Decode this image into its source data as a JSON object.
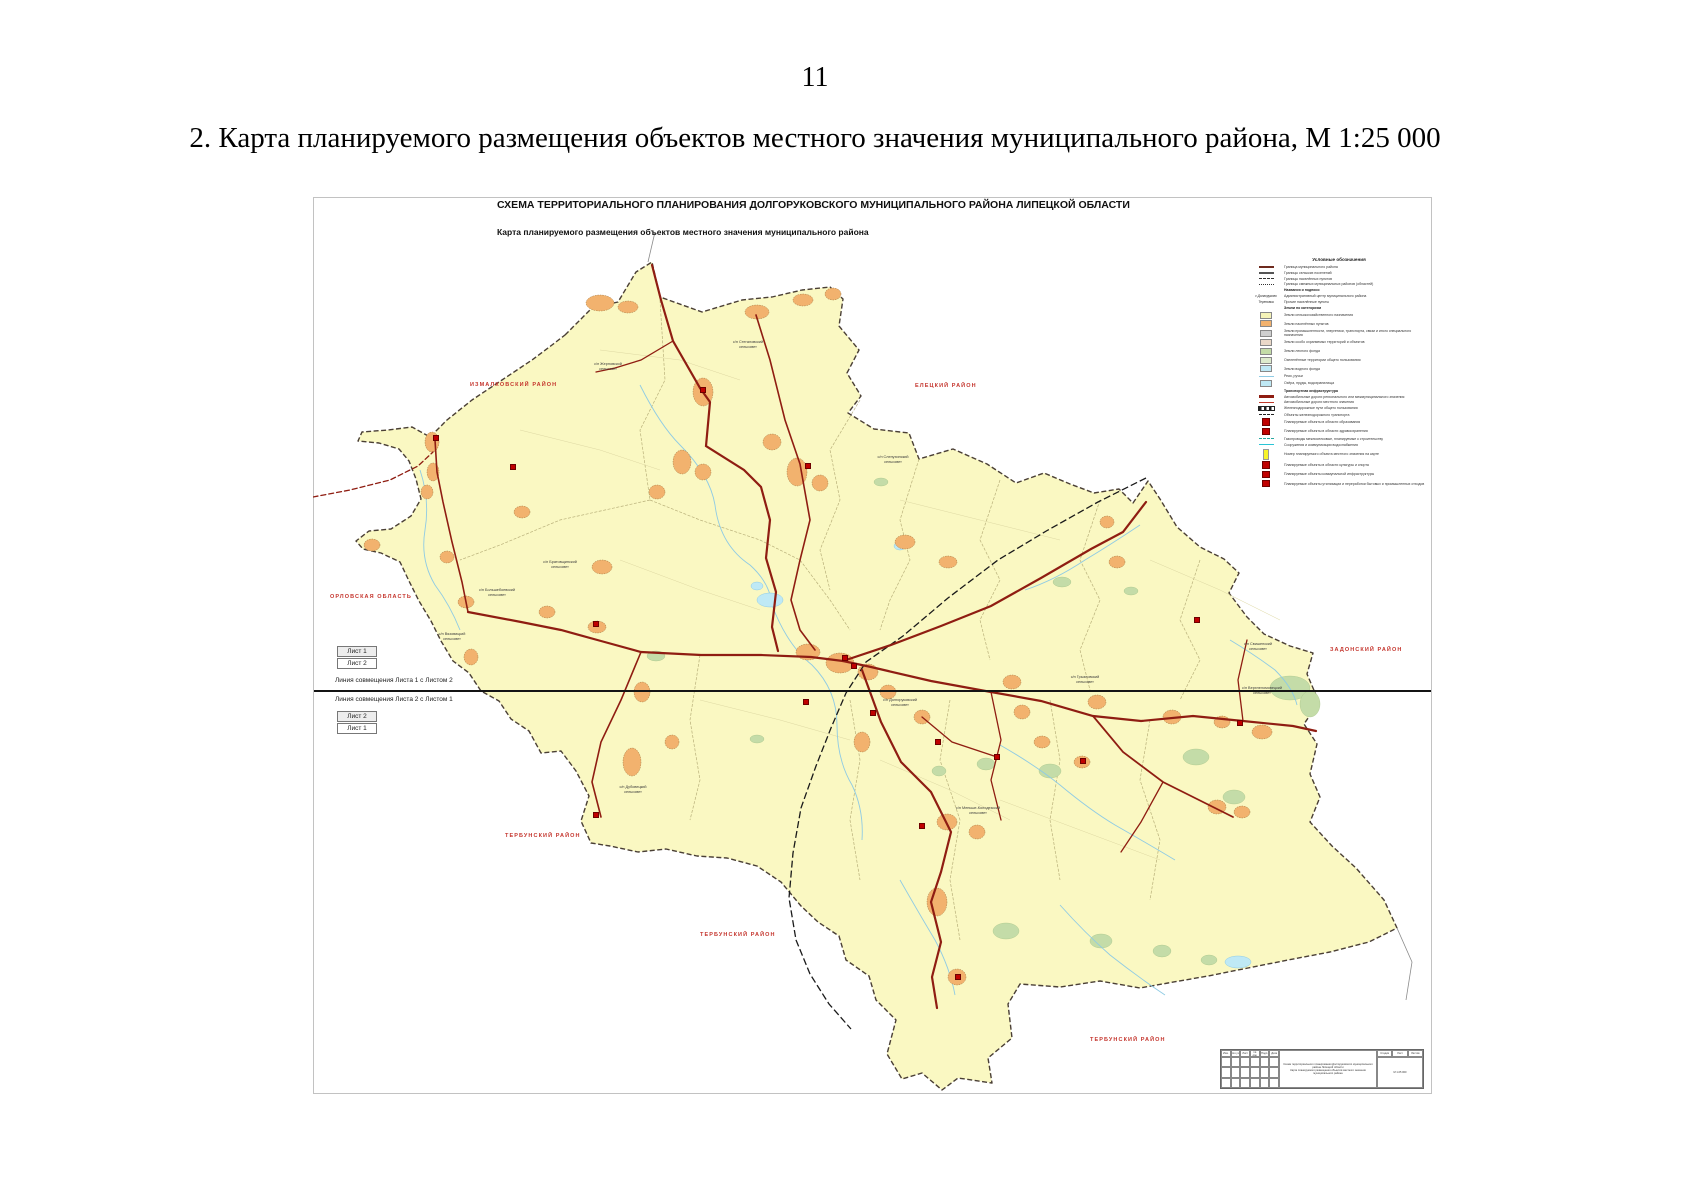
{
  "page": {
    "number": "11",
    "caption": "2. Карта планируемого размещения объектов местного значения муниципального района, М 1:25 000"
  },
  "sheet": {
    "title": "СХЕМА ТЕРРИТОРИАЛЬНОГО ПЛАНИРОВАНИЯ ДОЛГОРУКОВСКОГО МУНИЦИПАЛЬНОГО РАЙОНА ЛИПЕЦКОЙ ОБЛАСТИ",
    "subtitle": "Карта планируемого размещения объектов местного значения муниципального района"
  },
  "sheet_index": {
    "sheet1": "Лист 1",
    "sheet2": "Лист 2",
    "join1": "Линия совмещения Листа 1 с Листом 2",
    "join2": "Линия совмещения Листа 2 с Листом 1"
  },
  "legend": {
    "title": "Условные обозначения",
    "items": [
      {
        "sw": "band",
        "c": "#6e2a1e",
        "label": "Граница муниципального района"
      },
      {
        "sw": "band",
        "c": "#555555",
        "label": "Границы сельских поселений"
      },
      {
        "sw": "dash",
        "c": "#333333",
        "label": "Границы населённых пунктов"
      },
      {
        "sw": "dashdot",
        "c": "#333333",
        "label": "Границы смежных муниципальных районов (областей)"
      },
      {
        "sw": "none",
        "label": "Названия и подписи"
      },
      {
        "sw": "text",
        "st": "с.Долгоруково",
        "label": "Административный центр муниципального района"
      },
      {
        "sw": "text",
        "st": "Тереховка",
        "label": "Прочие населённые пункты"
      },
      {
        "sw": "none",
        "label": "Земли по категориям"
      },
      {
        "sw": "fill",
        "c": "#F5F3B8",
        "label": "Земли сельскохозяйственного назначения"
      },
      {
        "sw": "fill",
        "c": "#F2B26E",
        "label": "Земли населённых пунктов"
      },
      {
        "sw": "fill",
        "c": "#CFCFCF",
        "label": "Земли промышленности, энергетики, транспорта, связи и иного специального назначения"
      },
      {
        "sw": "fill",
        "c": "#EAD8C8",
        "label": "Земли особо охраняемых территорий и объектов"
      },
      {
        "sw": "fill",
        "c": "#C4DCA8",
        "label": "Земли лесного фонда"
      },
      {
        "sw": "fill",
        "c": "#DDEBCC",
        "label": "Озеленённые территории общего пользования"
      },
      {
        "sw": "bluefill",
        "c": "#BFE9F5",
        "label": "Земли водного фонда"
      },
      {
        "sw": "line",
        "c": "#8FCBE4",
        "label": "Реки, ручьи"
      },
      {
        "sw": "bluefill",
        "c": "#BFE9F5",
        "label": "Озёра, пруды, водохранилища"
      },
      {
        "sw": "none",
        "label": "Транспортная инфраструктура"
      },
      {
        "sw": "band",
        "c": "#8F1D12",
        "label": "Автомобильные дороги регионального или межмуниципального значения"
      },
      {
        "sw": "line",
        "c": "#C03A2B",
        "label": "Автомобильные дороги местного значения"
      },
      {
        "sw": "rail",
        "c": "#222222",
        "label": "Железнодорожные пути общего пользования"
      },
      {
        "sw": "dash",
        "c": "#222222",
        "label": "Объекты железнодорожного транспорта"
      },
      {
        "sw": "square",
        "c": "#C00000",
        "label": "Планируемые объекты в области образования"
      },
      {
        "sw": "square",
        "c": "#C00000",
        "label": "Планируемые объекты в области здравоохранения"
      },
      {
        "sw": "dash",
        "c": "#29A8A0",
        "label": "Газопроводы межпоселковые, планируемые к строительству"
      },
      {
        "sw": "line",
        "c": "#29C5D6",
        "label": "Сооружения и коммуникации водоснабжения"
      },
      {
        "sw": "tag",
        "c": "#F7F32A",
        "label": "Номер планируемого объекта местного значения на карте"
      },
      {
        "sw": "square",
        "c": "#C00000",
        "label": "Планируемые объекты в области культуры и спорта"
      },
      {
        "sw": "square",
        "c": "#C00000",
        "label": "Планируемые объекты коммунальной инфраструктуры"
      },
      {
        "sw": "square",
        "c": "#C00000",
        "label": "Планируемые объекты утилизации и переработки бытовых и промышленных отходов"
      }
    ]
  },
  "map": {
    "district_labels": [
      {
        "text": "ИЗМАЛКОВСКИЙ РАЙОН",
        "x": 470,
        "y": 382
      },
      {
        "text": "ЕЛЕЦКИЙ РАЙОН",
        "x": 915,
        "y": 383
      },
      {
        "text": "ОРЛОВСКАЯ ОБЛАСТЬ",
        "x": 330,
        "y": 594
      },
      {
        "text": "ЗАДОНСКИЙ РАЙОН",
        "x": 1330,
        "y": 647
      },
      {
        "text": "ТЕРБУНСКИЙ РАЙОН",
        "x": 505,
        "y": 833
      },
      {
        "text": "ТЕРБУНСКИЙ РАЙОН",
        "x": 700,
        "y": 932
      },
      {
        "text": "ТЕРБУНСКИЙ РАЙОН",
        "x": 1090,
        "y": 1037
      }
    ],
    "settlement_labels": [
      {
        "text": "с/п Жерновской\nсельсовет",
        "x": 608,
        "y": 362
      },
      {
        "text": "с/п Стегаловский\nсельсовет",
        "x": 748,
        "y": 340
      },
      {
        "text": "с/п Слепухинский\nсельсовет",
        "x": 893,
        "y": 455
      },
      {
        "text": "с/п Братовщинский\nсельсовет",
        "x": 560,
        "y": 560
      },
      {
        "text": "с/п Большебоевский\nсельсовет",
        "x": 497,
        "y": 588
      },
      {
        "text": "с/п Вязовицкий\nсельсовет",
        "x": 452,
        "y": 632
      },
      {
        "text": "с/п Дубовецкий\nсельсовет",
        "x": 633,
        "y": 785
      },
      {
        "text": "с/п Долгоруковский\nсельсовет",
        "x": 900,
        "y": 698
      },
      {
        "text": "с/п Грызловский\nсельсовет",
        "x": 1085,
        "y": 675
      },
      {
        "text": "с/п Меньше-Колодезский\nсельсовет",
        "x": 978,
        "y": 806
      },
      {
        "text": "с/п Свишенский\nсельсовет",
        "x": 1258,
        "y": 642
      },
      {
        "text": "с/п Верхнеломовецкий\nсельсовет",
        "x": 1262,
        "y": 686
      }
    ],
    "planned_object_markers": [
      [
        436,
        438
      ],
      [
        513,
        467
      ],
      [
        703,
        390
      ],
      [
        808,
        466
      ],
      [
        596,
        624
      ],
      [
        806,
        702
      ],
      [
        845,
        658
      ],
      [
        854,
        666
      ],
      [
        873,
        713
      ],
      [
        922,
        826
      ],
      [
        938,
        742
      ],
      [
        997,
        757
      ],
      [
        1083,
        761
      ],
      [
        1197,
        620
      ],
      [
        1240,
        723
      ],
      [
        596,
        815
      ],
      [
        958,
        977
      ]
    ]
  },
  "stamp": {
    "left_headers": [
      "Изм.",
      "Кол.уч.",
      "Лист",
      "№ док.",
      "Подп.",
      "Дата"
    ],
    "title_lines": [
      "Схема территориального планирования Долгоруковского муниципального района Липецкой области",
      "Карта планируемого размещения объектов местного значения муниципального района"
    ],
    "right_headers": [
      "Стадия",
      "Лист",
      "Листов"
    ],
    "scale": "М 1:25 000"
  },
  "colors": {
    "district_fill": "#FAF8C2",
    "settlement_fill": "#F2B26E",
    "forest_fill": "#C4DCA8",
    "water_fill": "#BFE9F5",
    "river_line": "#8FCBE4",
    "road_main": "#8F1D12",
    "boundary": "#4a3f35",
    "planned_object": "#C00000",
    "district_label": "#c4342c"
  }
}
